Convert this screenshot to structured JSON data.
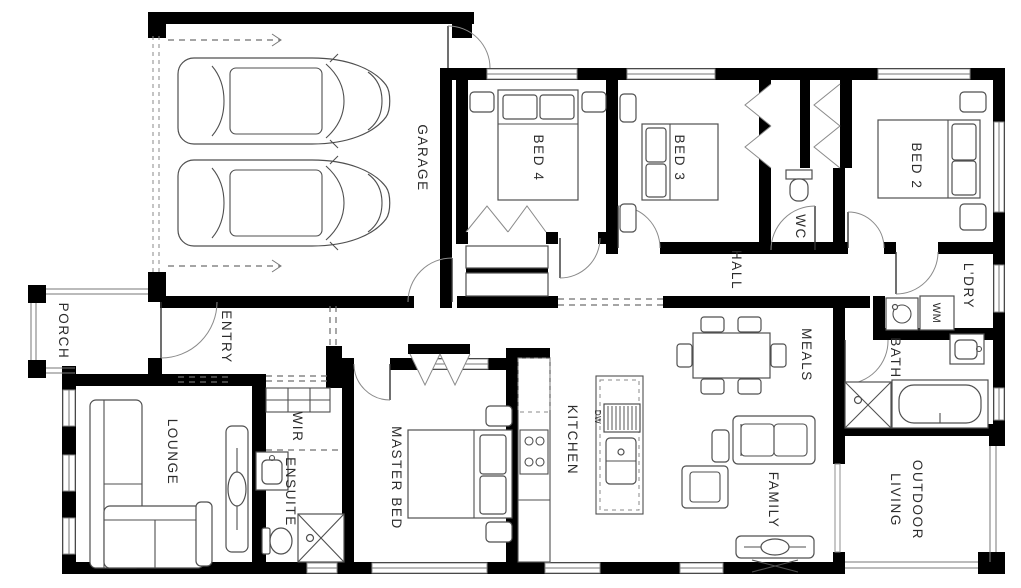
{
  "plan": {
    "rooms": {
      "garage": {
        "label": "GARAGE"
      },
      "porch": {
        "label": "PORCH"
      },
      "entry": {
        "label": "ENTRY"
      },
      "lounge": {
        "label": "LOUNGE"
      },
      "wir": {
        "label": "WIR"
      },
      "ensuite": {
        "label": "ENSUITE"
      },
      "master_bed": {
        "label": "MASTER BED"
      },
      "kitchen": {
        "label": "KITCHEN"
      },
      "bed4": {
        "label": "BED 4"
      },
      "bed3": {
        "label": "BED 3"
      },
      "bed2": {
        "label": "BED 2"
      },
      "wc": {
        "label": "WC"
      },
      "hall": {
        "label": "HALL"
      },
      "ldry": {
        "label": "L'DRY"
      },
      "bath": {
        "label": "BATH"
      },
      "meals": {
        "label": "MEALS"
      },
      "family": {
        "label": "FAMILY"
      },
      "outdoor_living": {
        "line1": "OUTDOOR",
        "line2": "LIVING"
      }
    },
    "appliances": {
      "dishwasher": "DW",
      "washing_machine": "WM"
    },
    "colors": {
      "wall": "#000000",
      "line": "#4f4f4f",
      "window": "#8f8f8f",
      "background": "#ffffff",
      "label": "#2c2c2c"
    }
  }
}
